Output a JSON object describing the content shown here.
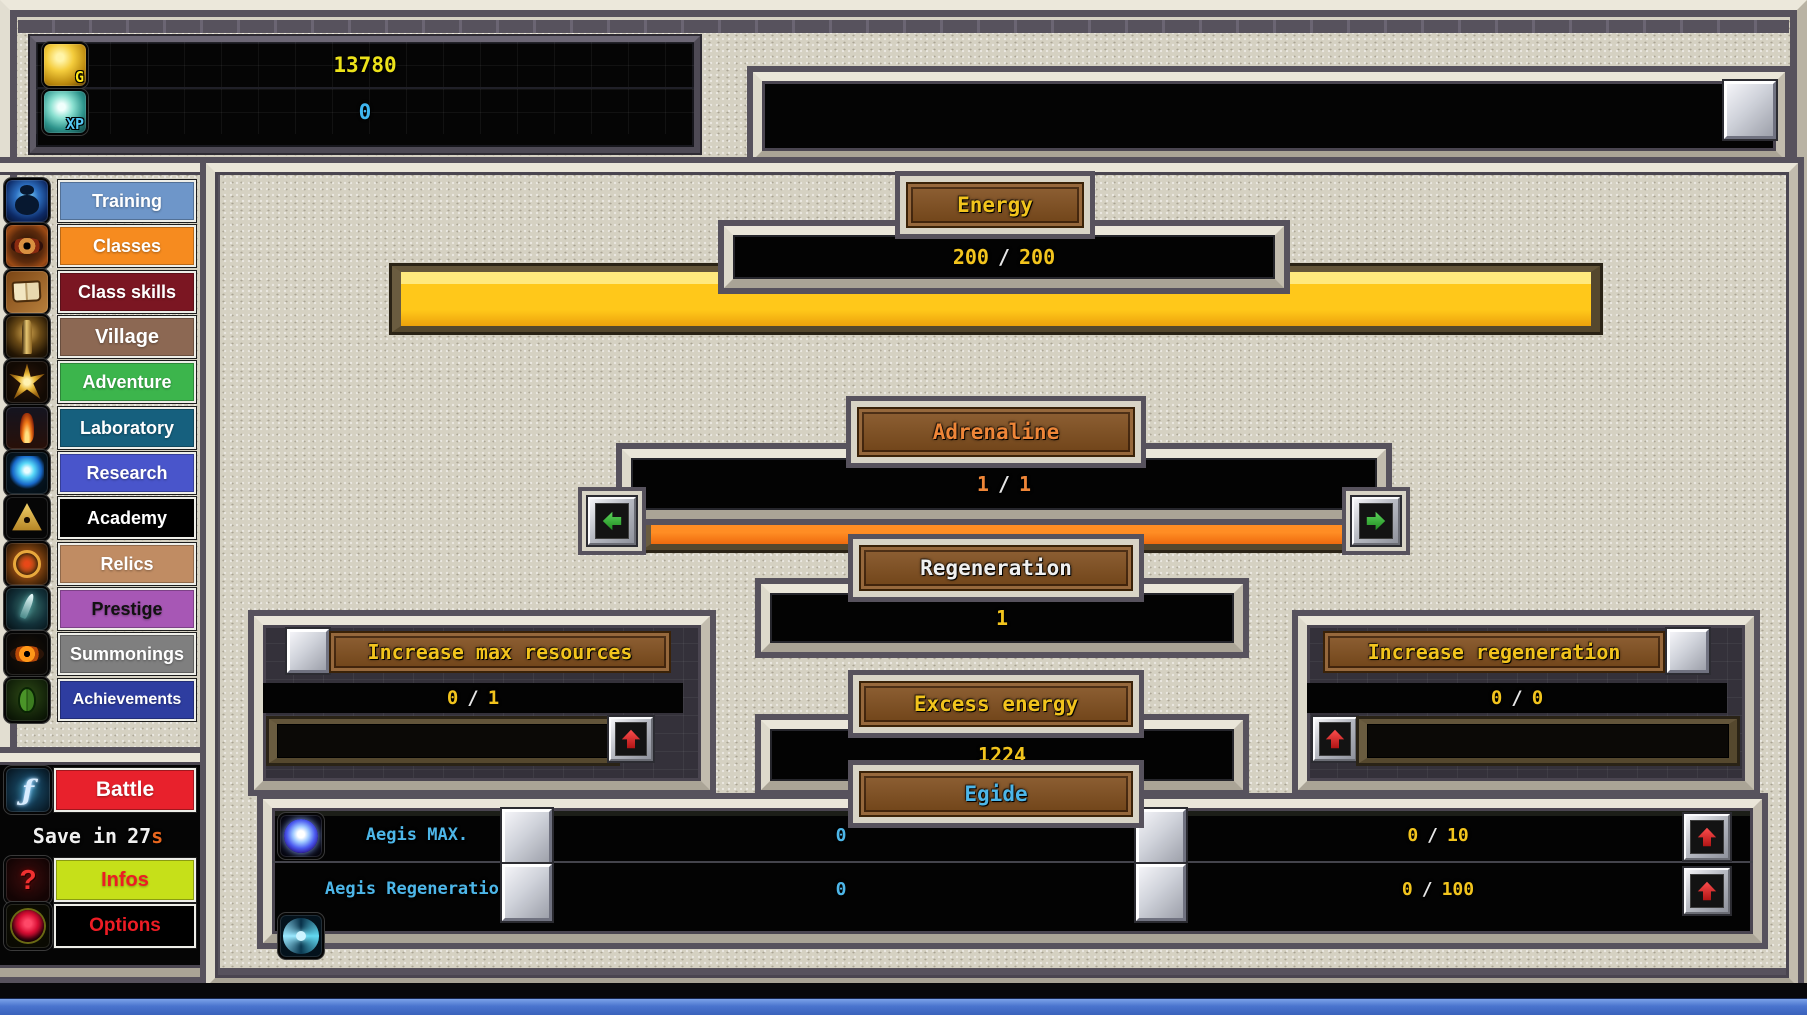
{
  "topbar": {
    "gold": {
      "label": "G",
      "value": "13780"
    },
    "xp": {
      "label": "XP",
      "value": "0"
    }
  },
  "sidebar": {
    "items": [
      {
        "label": "Training",
        "bg": "#6e96c9",
        "fg": "#ffffff"
      },
      {
        "label": "Classes",
        "bg": "#f68b1f",
        "fg": "#ffffff"
      },
      {
        "label": "Class skills",
        "bg": "#7b1622",
        "fg": "#ffffff"
      },
      {
        "label": "Village",
        "bg": "#8c6853",
        "fg": "#ffffff"
      },
      {
        "label": "Adventure",
        "bg": "#3cb54c",
        "fg": "#ffffff"
      },
      {
        "label": "Laboratory",
        "bg": "#16607e",
        "fg": "#ffffff"
      },
      {
        "label": "Research",
        "bg": "#4955cb",
        "fg": "#ffffff"
      },
      {
        "label": "Academy",
        "bg": "#000000",
        "fg": "#ffffff"
      },
      {
        "label": "Relics",
        "bg": "#c08c63",
        "fg": "#ffffff"
      },
      {
        "label": "Prestige",
        "bg": "#a757b5",
        "fg": "#111111"
      },
      {
        "label": "Summonings",
        "bg": "#7f7f7f",
        "fg": "#ffffff"
      },
      {
        "label": "Achievements",
        "bg": "#2e3da0",
        "fg": "#ffffff"
      }
    ]
  },
  "battle_panel": {
    "battle": {
      "label": "Battle",
      "bg": "#e8212c",
      "fg": "#ffffff"
    },
    "save": {
      "prefix": "Save in",
      "seconds": "27",
      "suffix": "s"
    },
    "infos": {
      "label": "Infos",
      "bg": "#c6e019",
      "fg": "#ed1c24"
    },
    "options": {
      "label": "Options",
      "bg": "#000000",
      "fg": "#ed1c24"
    }
  },
  "icons": {
    "battle": "ƒ",
    "infos": "?"
  },
  "main": {
    "energy": {
      "title": "Energy",
      "current": "200",
      "sep": "/",
      "max": "200",
      "pct": 100
    },
    "adrenaline": {
      "title": "Adrenaline",
      "current": "1",
      "sep": "/",
      "max": "1",
      "pct": 100
    },
    "regeneration": {
      "title": "Regeneration",
      "value": "1"
    },
    "increase_max": {
      "title": "Increase max resources",
      "current": "0",
      "sep": "/",
      "max": "1",
      "pct": 0
    },
    "excess": {
      "title": "Excess energy",
      "value": "1224"
    },
    "egide": {
      "title": "Egide"
    },
    "increase_regen": {
      "title": "Increase regeneration",
      "current": "0",
      "sep": "/",
      "max": "0",
      "pct": 0
    },
    "egide_rows": [
      {
        "label": "Aegis MAX.",
        "value": "0",
        "prog_current": "0",
        "sep": "/",
        "prog_max": "10"
      },
      {
        "label": "Aegis Regeneration",
        "value": "0",
        "prog_current": "0",
        "sep": "/",
        "prog_max": "100"
      }
    ]
  }
}
